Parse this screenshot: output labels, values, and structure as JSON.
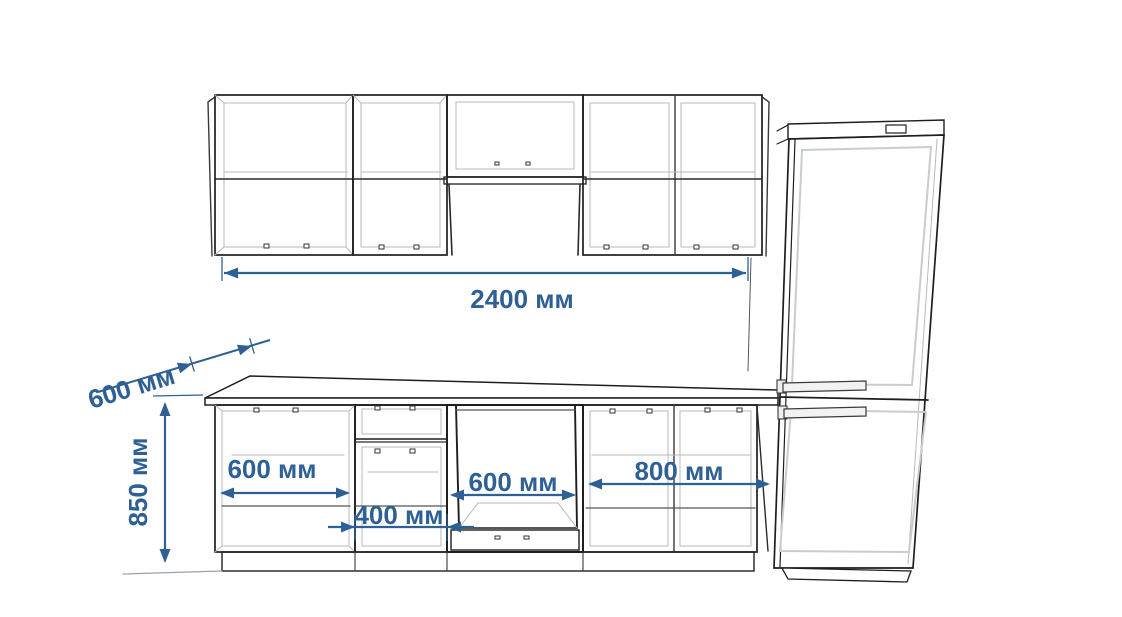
{
  "diagram": {
    "kind": "kitchen-elevation-drawing",
    "background": "#ffffff",
    "colors": {
      "dimension_blue": "#2e6096",
      "outline_dark": "#1e1e1e",
      "outline_medium": "#565656",
      "outline_light": "#b6babd",
      "fridge_door_inset": "#c9ccce"
    },
    "dims": {
      "wall_total": {
        "value": 2400,
        "unit": "мм",
        "label": "2400 мм"
      },
      "counter_depth": {
        "value": 600,
        "unit": "мм",
        "label": "600 мм"
      },
      "base_height": {
        "value": 850,
        "unit": "мм",
        "label": "850 мм"
      },
      "base_left": {
        "value": 600,
        "unit": "мм",
        "label": "600 мм"
      },
      "drawer_unit": {
        "value": 400,
        "unit": "мм",
        "label": "400 мм"
      },
      "niche": {
        "value": 600,
        "unit": "мм",
        "label": "600 мм"
      },
      "base_right": {
        "value": 800,
        "unit": "мм",
        "label": "800 мм"
      }
    }
  }
}
